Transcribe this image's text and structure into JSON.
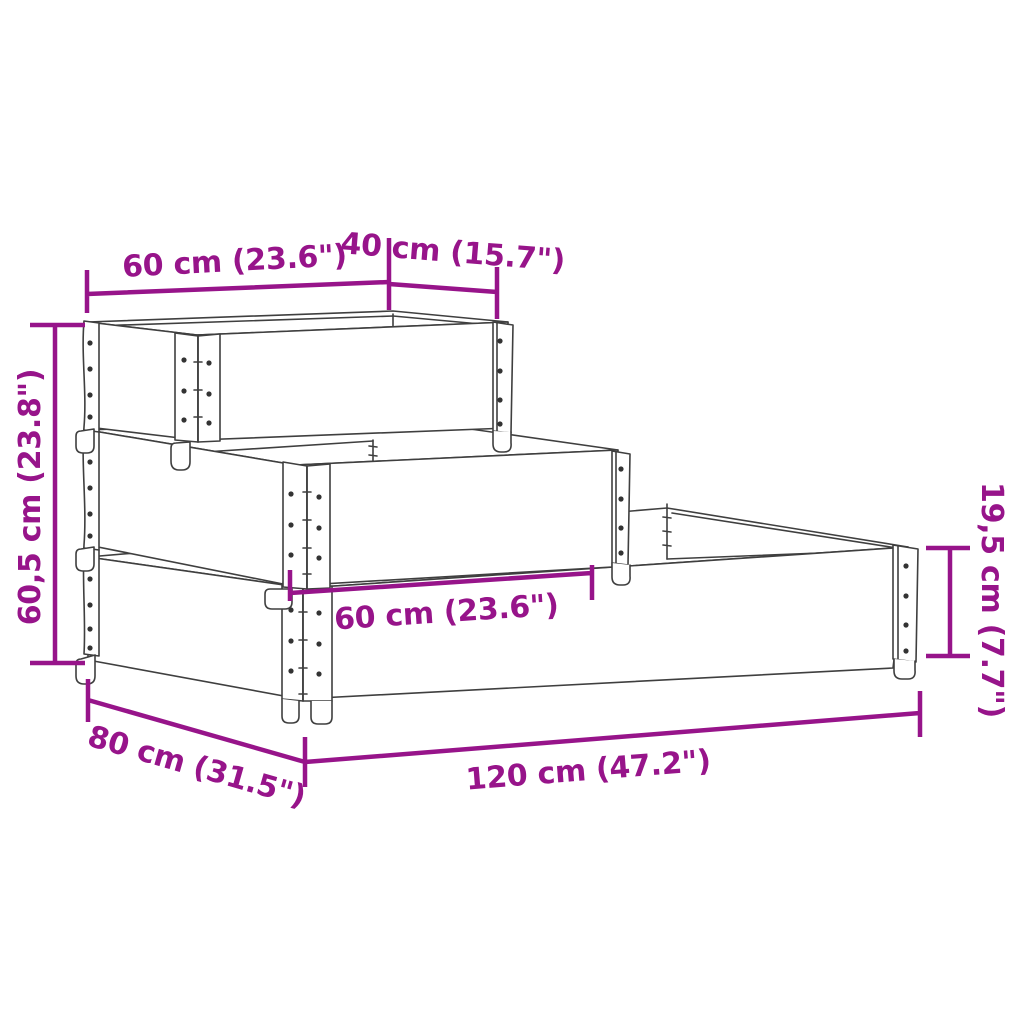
{
  "canvas": {
    "width": 1024,
    "height": 1024,
    "background": "#ffffff"
  },
  "style": {
    "dimension_color": "#97148A",
    "outline_color": "#3f3f3f",
    "rivet_color": "#333333"
  },
  "product": {
    "kind": "3-tier-pallet-collar-raised-bed-dimension-diagram"
  },
  "dimensions": {
    "top_width": {
      "label": "60 cm (23.6\")",
      "value_cm": 60
    },
    "top_depth": {
      "label": "40 cm (15.7\")",
      "value_cm": 40
    },
    "total_height": {
      "label": "60,5 cm (23.8\")",
      "value_cm": 60.5
    },
    "middle_width": {
      "label": "60 cm (23.6\")",
      "value_cm": 60
    },
    "tier_height": {
      "label": "19,5 cm (7.7\")",
      "value_cm": 19.5
    },
    "base_depth": {
      "label": "80 cm (31.5\")",
      "value_cm": 80
    },
    "base_width": {
      "label": "120 cm (47.2\")",
      "value_cm": 120
    }
  }
}
